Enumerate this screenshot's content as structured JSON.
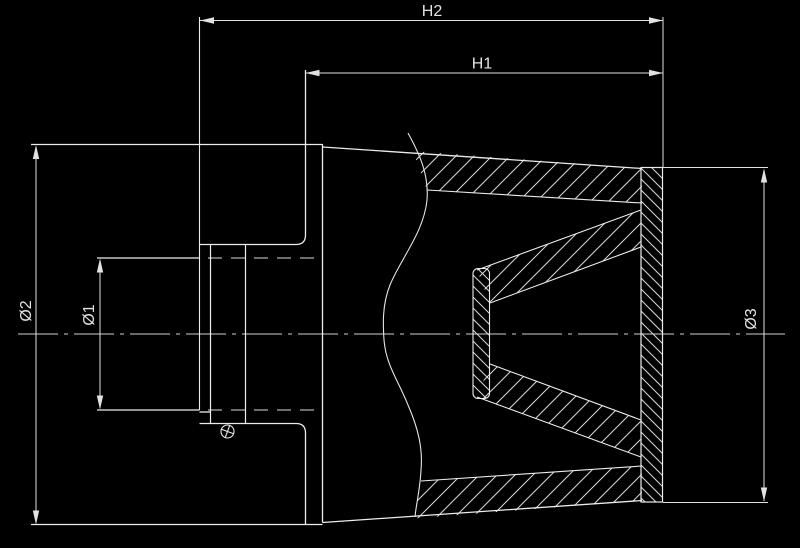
{
  "drawing": {
    "type": "technical-section-drawing",
    "subject": "conical air filter cross-section",
    "colors": {
      "background": "#000000",
      "outline": "#ececec",
      "dimension_line": "#e2e2e2",
      "hatch": "#d9d9d9",
      "text": "#e2e2e2"
    },
    "dimensions": {
      "h2": {
        "label": "H2"
      },
      "h1": {
        "label": "H1"
      },
      "d2": {
        "label": "Ø2"
      },
      "d1": {
        "label": "Ø1"
      },
      "d3": {
        "label": "Ø3"
      }
    }
  }
}
